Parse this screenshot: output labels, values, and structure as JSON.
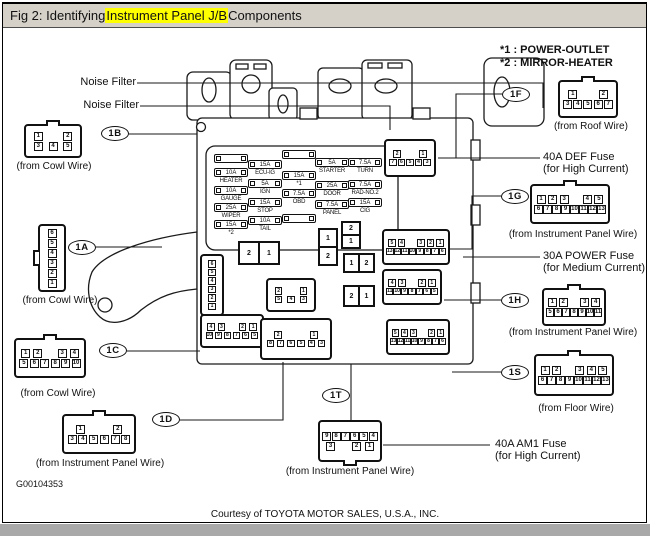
{
  "title": {
    "prefix": "Fig 2: Identifying ",
    "highlight": "Instrument Panel J/B",
    "suffix": " Components"
  },
  "legend": {
    "line1": "*1 : POWER-OUTLET",
    "line2": "*2 : MIRROR-HEATER"
  },
  "labels": {
    "noise_filter_1": "Noise Filter",
    "noise_filter_2": "Noise Filter",
    "def_fuse_1": "40A DEF Fuse",
    "def_fuse_2": "(for High Current)",
    "power_fuse_1": "30A POWER Fuse",
    "power_fuse_2": "(for Medium Current)",
    "am1_fuse_1": "40A AM1 Fuse",
    "am1_fuse_2": "(for High Current)",
    "doc_code": "G00104353",
    "courtesy": "Courtesy of TOYOTA MOTOR SALES, U.S.A., INC."
  },
  "connectors": {
    "c1b": {
      "label": "1B",
      "caption": "(from Cowl Wire)",
      "rows": [
        [
          "1",
          "",
          "2"
        ],
        [
          "3",
          "4",
          "5"
        ]
      ]
    },
    "c1a": {
      "label": "1A",
      "caption": "(from Cowl Wire)",
      "rows": [
        [
          "6"
        ],
        [
          "5"
        ],
        [
          "4"
        ],
        [
          "3"
        ],
        [
          "2"
        ],
        [
          "1"
        ]
      ]
    },
    "c1c": {
      "label": "1C",
      "caption": "(from Cowl Wire)",
      "rows": [
        [
          "1",
          "2",
          "",
          "3",
          "4"
        ],
        [
          "5",
          "6",
          "7",
          "8",
          "9",
          "10"
        ]
      ]
    },
    "c1d": {
      "label": "1D",
      "caption": "(from Instrument Panel Wire)",
      "rows": [
        [
          "1",
          "",
          "2"
        ],
        [
          "3",
          "4",
          "5",
          "6",
          "7",
          "8"
        ]
      ]
    },
    "c1f": {
      "label": "1F",
      "caption": "(from Roof Wire)",
      "rows": [
        [
          "1",
          "",
          "2"
        ],
        [
          "3",
          "4",
          "5",
          "6",
          "7"
        ]
      ]
    },
    "c1g": {
      "label": "1G",
      "caption": "(from Instrument Panel Wire)",
      "rows": [
        [
          "1",
          "2",
          "3",
          "",
          "4",
          "5"
        ],
        [
          "6",
          "7",
          "8",
          "9",
          "10",
          "11",
          "12",
          "13"
        ]
      ]
    },
    "c1h": {
      "label": "1H",
      "caption": "(from Instrument Panel Wire)",
      "rows": [
        [
          "1",
          "2",
          "",
          "3",
          "4"
        ],
        [
          "5",
          "6",
          "7",
          "8",
          "9",
          "10",
          "11"
        ]
      ]
    },
    "c1s": {
      "label": "1S",
      "caption": "(from Floor Wire)",
      "rows": [
        [
          "1",
          "2",
          "",
          "3",
          "4",
          "5"
        ],
        [
          "6",
          "7",
          "8",
          "9",
          "10",
          "11",
          "12",
          "13"
        ]
      ]
    },
    "c1t": {
      "label": "1T",
      "caption": "(from Instrument Panel Wire)",
      "rows": [
        [
          "9",
          "8",
          "7",
          "6",
          "5",
          "4"
        ],
        [
          "3",
          "",
          "2",
          "1"
        ]
      ]
    },
    "int_roof": {
      "rows": [
        [
          "2",
          "",
          "1"
        ],
        [
          "7",
          "6",
          "5",
          "4",
          "3"
        ]
      ]
    },
    "int_a": {
      "rows": [
        [
          "6"
        ],
        [
          "5"
        ],
        [
          "4"
        ],
        [
          "3"
        ],
        [
          "2"
        ],
        [
          "1"
        ]
      ]
    },
    "int_e": {
      "rows": [
        [
          "2",
          "",
          "1"
        ],
        [
          "5",
          "4",
          "3"
        ]
      ]
    },
    "int_c": {
      "rows": [
        [
          "4",
          "3",
          "",
          "2",
          "1"
        ],
        [
          "10",
          "9",
          "8",
          "7",
          "6",
          "5"
        ]
      ]
    },
    "int_d": {
      "rows": [
        [
          "2",
          "",
          "1"
        ],
        [
          "8",
          "7",
          "6",
          "5",
          "4",
          "3"
        ]
      ]
    },
    "int_g": {
      "rows": [
        [
          "5",
          "4",
          "",
          "3",
          "2",
          "1"
        ],
        [
          "13",
          "12",
          "11",
          "10",
          "9",
          "8",
          "7",
          "6"
        ]
      ]
    },
    "int_h": {
      "rows": [
        [
          "4",
          "3",
          "",
          "2",
          "1"
        ],
        [
          "11",
          "10",
          "9",
          "8",
          "7",
          "6",
          "5"
        ]
      ]
    },
    "int_s": {
      "rows": [
        [
          "5",
          "4",
          "3",
          "",
          "2",
          "1"
        ],
        [
          "13",
          "12",
          "11",
          "10",
          "9",
          "8",
          "7",
          "6"
        ]
      ]
    }
  },
  "fuses": {
    "blank": {
      "amp": "",
      "name": ""
    },
    "heater": {
      "amp": "10A",
      "name": "HEATER"
    },
    "gauge": {
      "amp": "10A",
      "name": "GAUGE"
    },
    "wiper": {
      "amp": "25A",
      "name": "WIPER"
    },
    "star2": {
      "amp": "15A",
      "name": "*2"
    },
    "ecuig": {
      "amp": "15A",
      "name": "ECU-IG"
    },
    "ign": {
      "amp": "5A",
      "name": "IGN"
    },
    "stop": {
      "amp": "15A",
      "name": "STOP"
    },
    "tail": {
      "amp": "10A",
      "name": "TAIL"
    },
    "star1": {
      "amp": "15A",
      "name": "*1"
    },
    "obd": {
      "amp": "7.5A",
      "name": "OBD"
    },
    "starter": {
      "amp": "5A",
      "name": "STARTER"
    },
    "door": {
      "amp": "25A",
      "name": "DOOR"
    },
    "panel": {
      "amp": "7.5A",
      "name": "PANEL"
    },
    "turn": {
      "amp": "7.5A",
      "name": "TURN"
    },
    "radno2": {
      "amp": "7.5A",
      "name": "RAD-NO.2"
    },
    "cig": {
      "amp": "15A",
      "name": "CIG"
    }
  },
  "relays": {
    "rA": {
      "cells": [
        "2",
        "1"
      ]
    },
    "rB": {
      "cells": [
        "1",
        "2"
      ]
    },
    "rC": {
      "cells": [
        "2",
        "1"
      ]
    },
    "rD": {
      "cells": [
        "1",
        "2"
      ]
    },
    "rE": {
      "cells": [
        "2",
        "1"
      ]
    }
  }
}
